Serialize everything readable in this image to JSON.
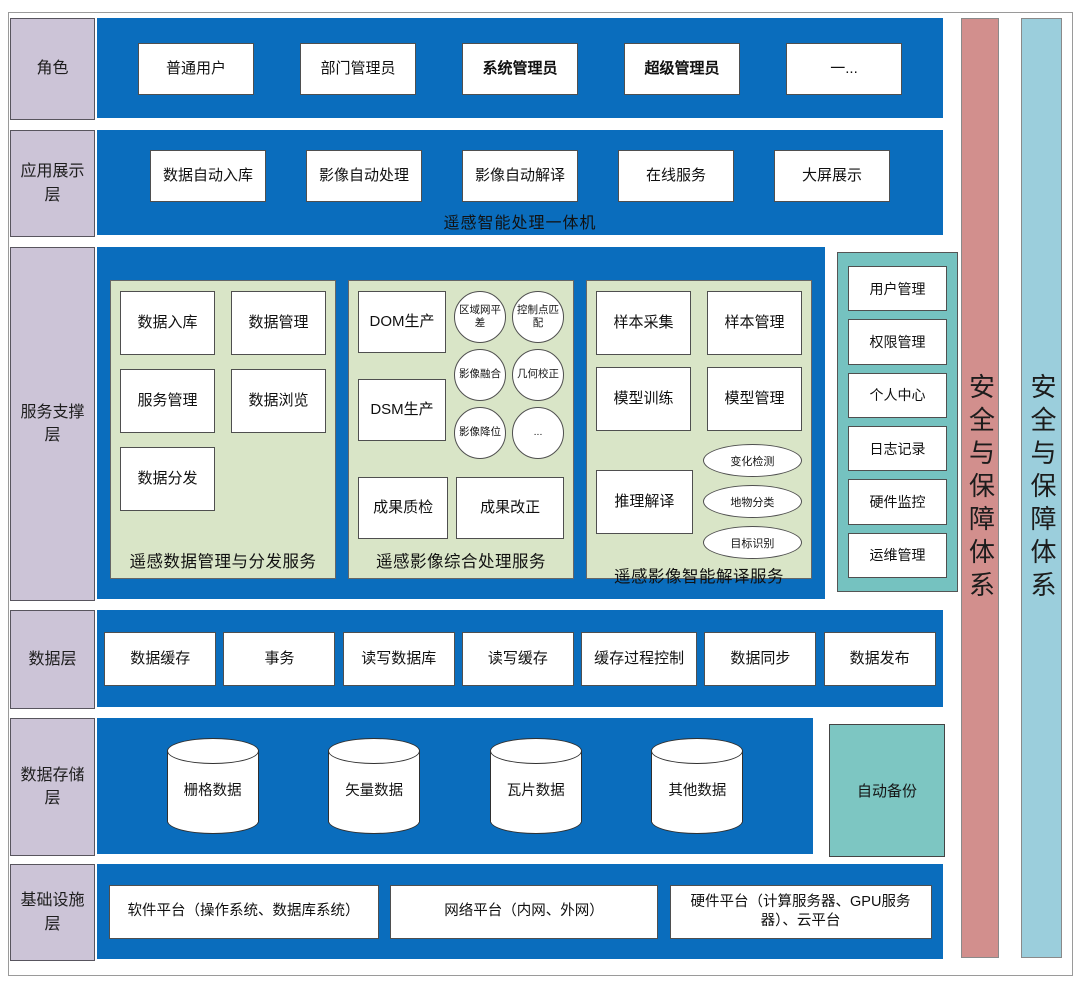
{
  "layers": {
    "roles": {
      "label": "角色",
      "items": [
        "普通用户",
        "部门管理员",
        "系统管理员",
        "超级管理员",
        "一..."
      ]
    },
    "app": {
      "label": "应用展示\n层",
      "items": [
        "数据自动入库",
        "影像自动处理",
        "影像自动解译",
        "在线服务",
        "大屏展示"
      ],
      "caption": "遥感智能处理一体机"
    },
    "service": {
      "label": "服务支撑\n层",
      "panels": [
        {
          "title": "遥感数据管理与分发服务",
          "boxes": [
            "数据入库",
            "数据管理",
            "服务管理",
            "数据浏览",
            "数据分发"
          ]
        },
        {
          "title": "遥感影像综合处理服务",
          "boxes": [
            "DOM生产",
            "DSM生产",
            "成果质检",
            "成果改正"
          ],
          "circles": [
            "区域网平差",
            "控制点匹配",
            "影像融合",
            "几何校正",
            "影像降位",
            "..."
          ]
        },
        {
          "title": "遥感影像智能解译服务",
          "boxes": [
            "样本采集",
            "样本管理",
            "模型训练",
            "模型管理",
            "推理解译"
          ],
          "ellipses": [
            "变化检测",
            "地物分类",
            "目标识别"
          ]
        }
      ],
      "utility": {
        "items": [
          "用户管理",
          "权限管理",
          "个人中心",
          "日志记录",
          "硬件监控",
          "运维管理"
        ]
      }
    },
    "data": {
      "label": "数据层",
      "items": [
        "数据缓存",
        "事务",
        "读写数据库",
        "读写缓存",
        "缓存过程控制",
        "数据同步",
        "数据发布"
      ]
    },
    "storage": {
      "label": "数据存储\n层",
      "cylinders": [
        "栅格数据",
        "矢量数据",
        "瓦片数据",
        "其他数据"
      ],
      "backup": "自动备份"
    },
    "infra": {
      "label": "基础设施\n层",
      "items": [
        "软件平台（操作系统、数据库系统）",
        "网络平台（内网、外网）",
        "硬件平台（计算服务器、GPU服务器）、云平台"
      ]
    }
  },
  "security_bars": [
    "安全与保障体系",
    "安全与保障体系"
  ],
  "colors": {
    "band_blue": "#0a6dbd",
    "label_purple": "#ccc4d7",
    "panel_green": "#d9e5c7",
    "utility_teal": "#75c2c0",
    "backup_teal": "#7dc6c2",
    "bar_pink": "#d28f8d",
    "bar_lightblue": "#9bcedc"
  }
}
